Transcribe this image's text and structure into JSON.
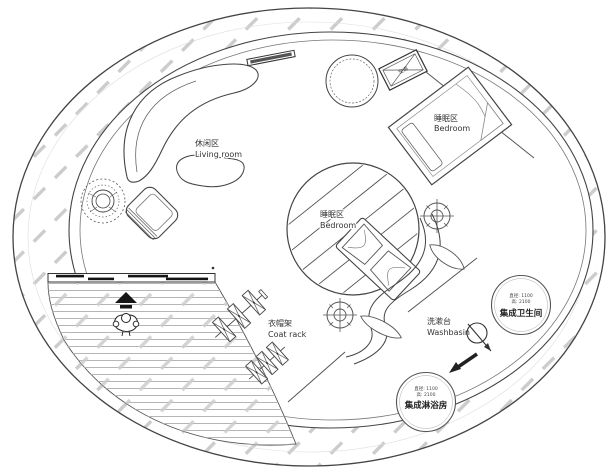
{
  "colors": {
    "line": "#444444",
    "line_dark": "#222222",
    "hatch": "#cccccc",
    "deck_line": "#b5b5b5",
    "text": "#333333",
    "solid_black": "#151515",
    "background": "#ffffff"
  },
  "labels": {
    "living_room": {
      "zh": "休闲区",
      "en": "Living room"
    },
    "bedroom_upper": {
      "zh": "睡眠区",
      "en": "Bedroom"
    },
    "bedroom_center": {
      "zh": "睡眠区",
      "en": "Bedroom"
    },
    "coat_rack": {
      "zh": "衣帽架",
      "en": "Coat rack"
    },
    "washbasin": {
      "zh": "洗漱台",
      "en": "Washbasin"
    },
    "ac_unit": {
      "zh": "空调"
    },
    "bathroom_pod": {
      "dim_diameter": "直径: 1100",
      "dim_height": "高: 2100",
      "name": "集成卫生间"
    },
    "shower_pod": {
      "dim_diameter": "直径: 1100",
      "dim_height": "高: 2100",
      "name": "集成淋浴房"
    }
  }
}
